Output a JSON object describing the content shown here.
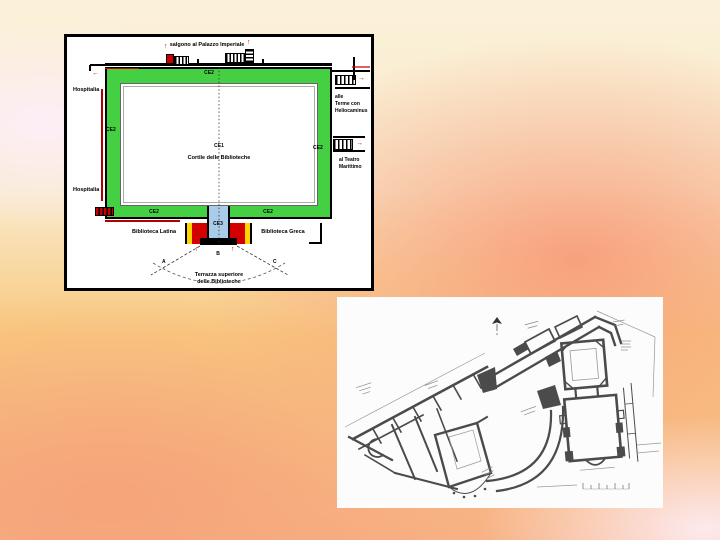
{
  "slide": {
    "background_colors": [
      "#fbf1d9",
      "#fdeef9",
      "#f79b79",
      "#f7b285",
      "#fdedf3"
    ]
  },
  "icons": {
    "arrow_up": "↑",
    "arrow_left": "←",
    "arrow_right": "→"
  },
  "plan1": {
    "description": "colored plan of the courtyard of the libraries",
    "colors": {
      "portico_green": "#45d043",
      "passage_blue": "#a9cce9",
      "arrow_red": "#cc0000",
      "stripe_yellow": "#ffd400",
      "stripe_red": "#d40000"
    },
    "labels": {
      "top_exit": "salgono al Palazzo Imperiale",
      "ce2_top": "CE2",
      "ce2_left": "CE2",
      "ce2_right": "CE2",
      "ce2_bottom_left": "CE2",
      "ce2_bottom_right": "CE2",
      "hospitalia_upper": "Hospitalia",
      "hospitalia_lower": "Hospitalia",
      "terme": [
        "alle",
        "Terme con",
        "Heliocaminus"
      ],
      "teatro": [
        "al Teatro",
        "Marittimo"
      ],
      "ce1": "CE1",
      "cortile": "Cortile delle Biblioteche",
      "ce3": "CE3",
      "biblioteca_latina": "Biblioteca Latina",
      "biblioteca_greca": "Biblioteca Greca",
      "point_a": "A",
      "point_b": "B",
      "point_c": "C",
      "terrazza": [
        "Terrazza superiore",
        "delle Biblioteche"
      ]
    }
  },
  "plan2": {
    "description": "black and white archaeological floor plan",
    "ink": "#4b4b4b",
    "paper": "#fcfcfc"
  }
}
